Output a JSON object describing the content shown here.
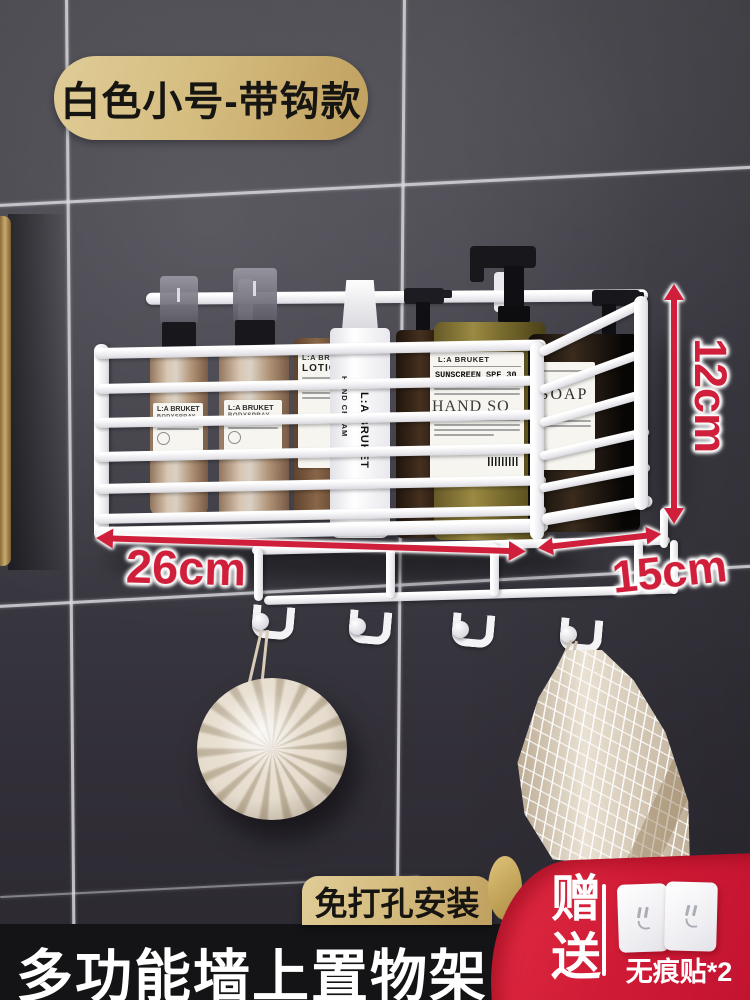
{
  "variant_badge": {
    "label": "白色小号-带钩款"
  },
  "dimensions": {
    "width": "26cm",
    "height": "12cm",
    "depth": "15cm"
  },
  "shelf_items": {
    "spray_brand": "L:A BRUKET",
    "spray_line": "BODYSPRAY",
    "lotion_brand": "L:A BRU",
    "lotion_name": "LOTION",
    "tube_line1": "HAND CREAM",
    "tube_line2": "L:A BRUKET",
    "sunscreen_brand": "L:A BRUKET",
    "sunscreen_name": "SUNSCREEN SPF 30",
    "sunscreen_big": "HAND SO",
    "soap_name": "SOAP"
  },
  "install_badge": {
    "label": "免打孔安装"
  },
  "footer": {
    "title": "多功能墙上置物架"
  },
  "gift": {
    "label": "赠送",
    "item": "无痕贴*2"
  },
  "colors": {
    "accent_red": "#d01f3a",
    "banner_red": "#d5203a",
    "badge_gold": "#d5bd80",
    "wire_white": "#f7f7f9",
    "footer_black": "#141416",
    "wall_dark": "#3a3941",
    "towel_cream": "#e2d7c4"
  }
}
